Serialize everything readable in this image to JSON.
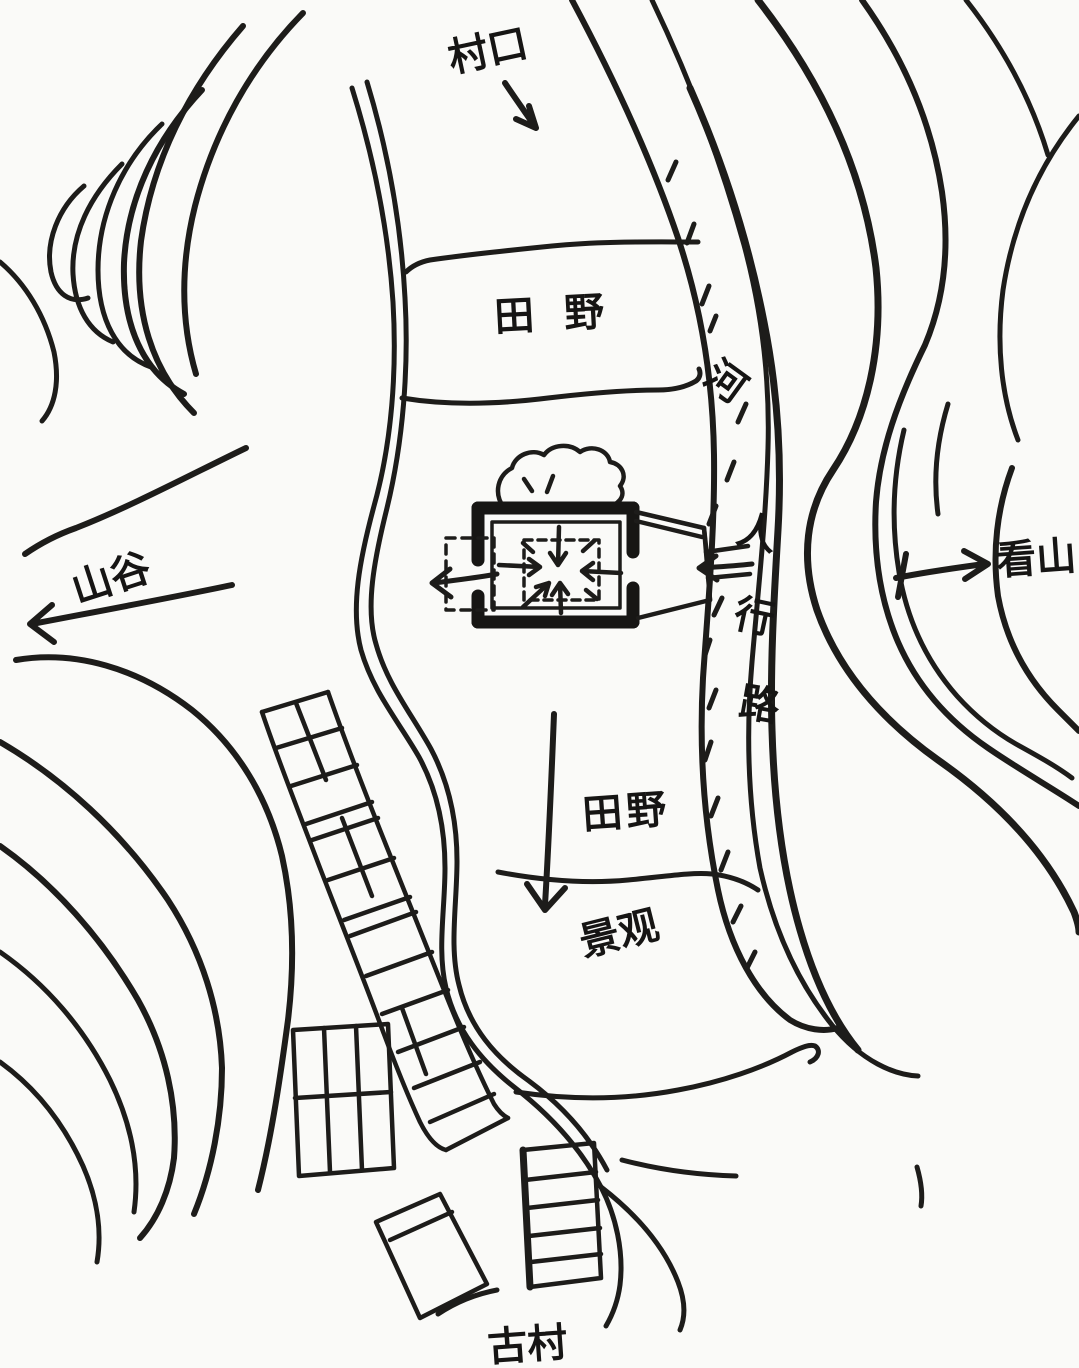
{
  "map": {
    "type": "hand-drawn site sketch map",
    "labels": {
      "village_gate": "村口",
      "field_upper": "田 野",
      "river": "河",
      "path": "人行路",
      "path_chars": [
        "人",
        "行",
        "路"
      ],
      "valley": "山谷",
      "view_mountain": "看山",
      "field_lower": "田野",
      "landscape_view": "景观",
      "ancient_village": "古村"
    },
    "colors": {
      "ink": "#1d1c1a",
      "paper": "#fafaf8"
    }
  }
}
